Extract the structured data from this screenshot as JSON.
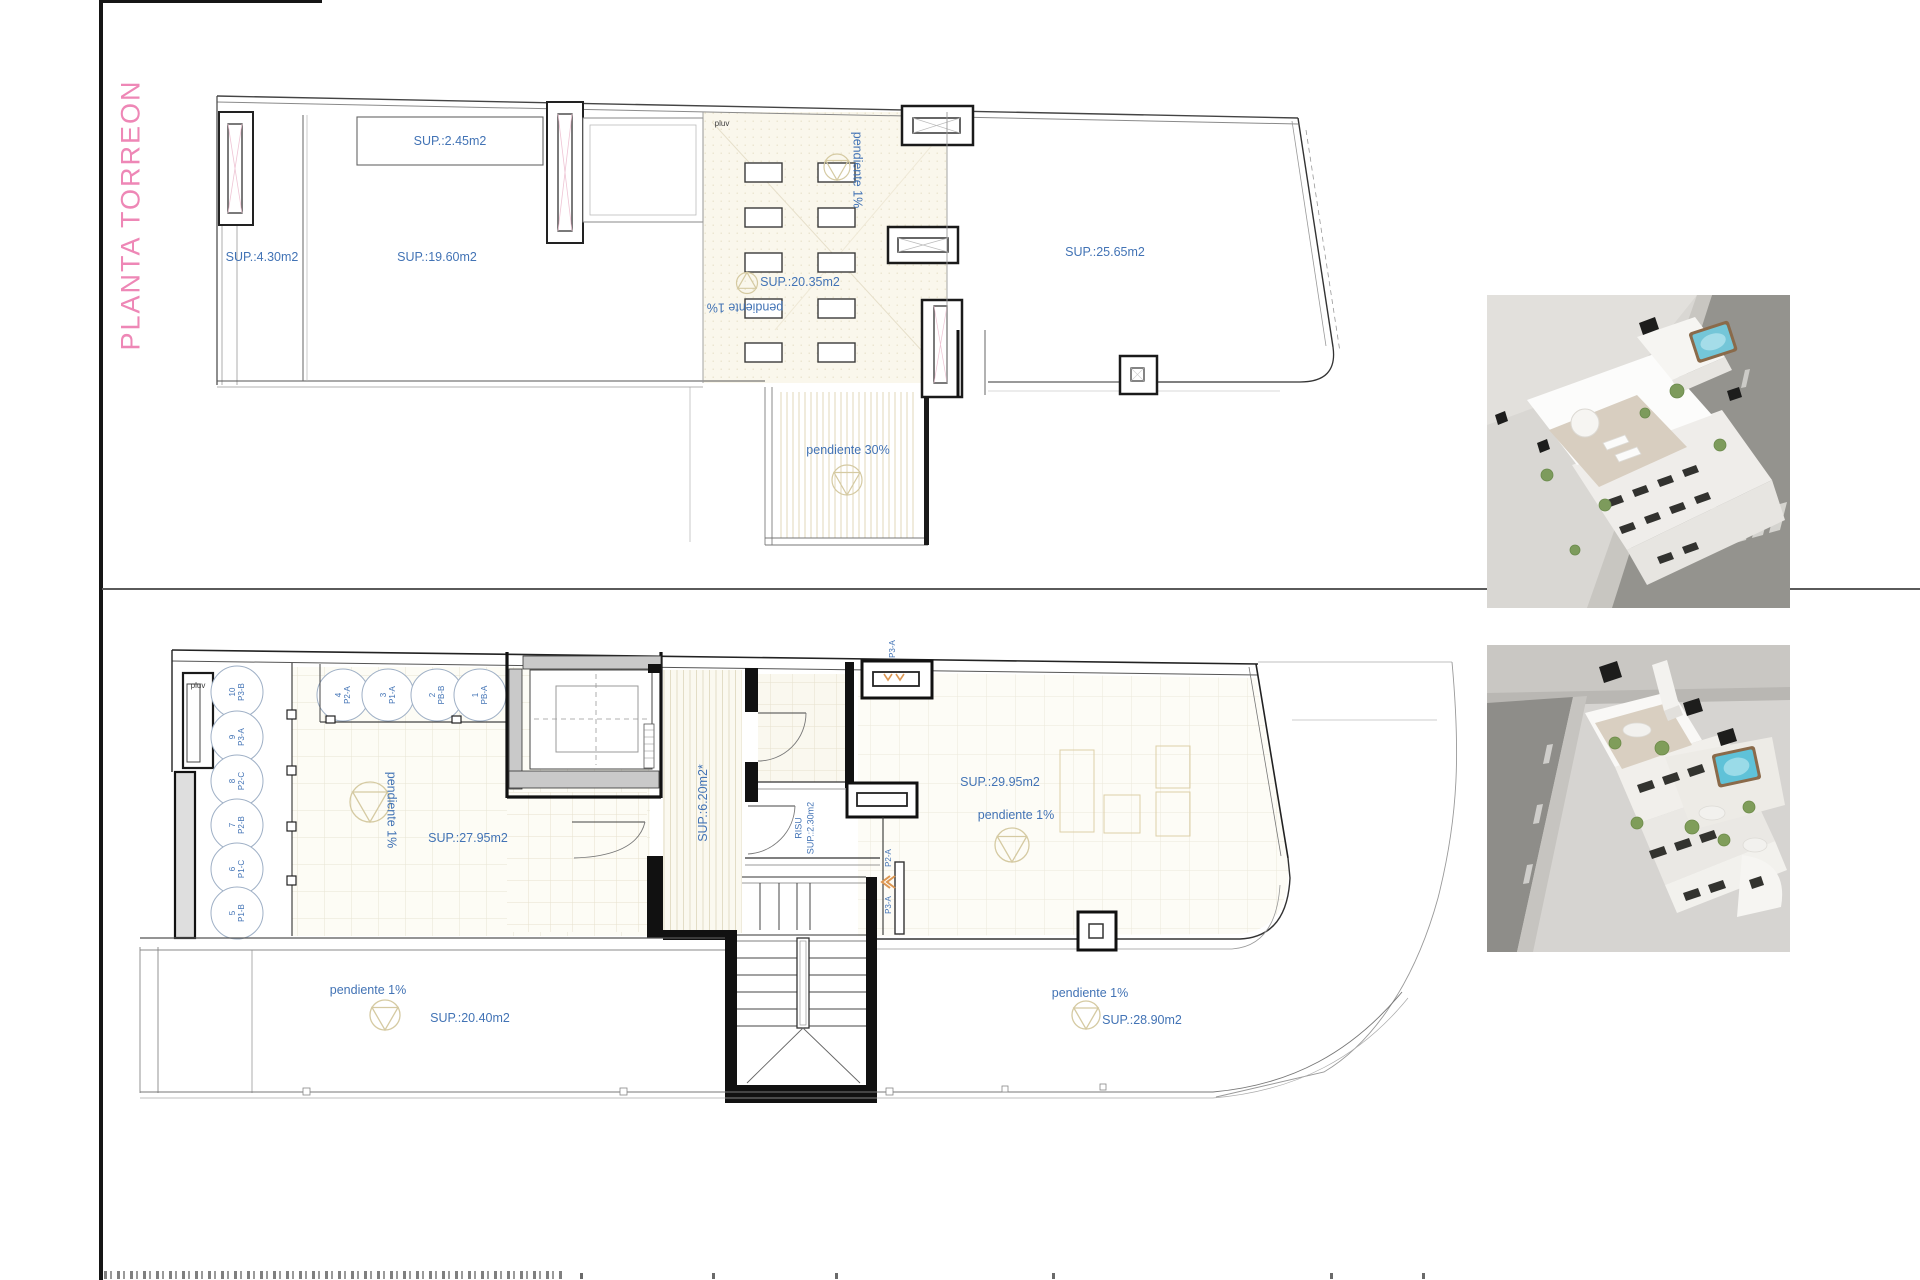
{
  "sheet": {
    "title": "PLANTA TORREON",
    "accent_pink": "#ee87b6",
    "label_blue": "#4273b5"
  },
  "top_plan": {
    "note_pluv": "pluv",
    "areas": {
      "box": "SUP.:2.45m2",
      "left_strip": "SUP.:4.30m2",
      "main": "SUP.:19.60m2",
      "mid": "SUP.:20.35m2",
      "right": "SUP.:25.65m2"
    },
    "slopes": {
      "mid_vertical": "pendiente 1%",
      "mid_inverted": "pendiente 1%",
      "ramp": "pendiente 30%"
    }
  },
  "bottom_plan": {
    "note_pluv": "pluv",
    "areas": {
      "left_terrace": "SUP.:27.95m2",
      "corridor": "SUP.:6.20m2*",
      "risu_room": "RISU",
      "risu_area": "SUP.:2.30m2",
      "right_terrace": "SUP.:29.95m2",
      "bottom_left_terrace": "SUP.:20.40m2",
      "bottom_right_terrace": "SUP.:28.90m2"
    },
    "slopes": {
      "left_terrace": "pendiente 1%",
      "right_terrace": "pendiente 1%",
      "bottom_left": "pendiente 1%",
      "bottom_right": "pendiente 1%"
    },
    "tanks_left": [
      {
        "num": "10",
        "code": "P3-B"
      },
      {
        "num": "9",
        "code": "P3-A"
      },
      {
        "num": "8",
        "code": "P2-C"
      },
      {
        "num": "7",
        "code": "P2-B"
      },
      {
        "num": "6",
        "code": "P1-C"
      },
      {
        "num": "5",
        "code": "P1-B"
      }
    ],
    "tanks_top": [
      {
        "num": "4",
        "code": "P2-A"
      },
      {
        "num": "3",
        "code": "P1-A"
      },
      {
        "num": "2",
        "code": "PB-B"
      },
      {
        "num": "1",
        "code": "PB-A"
      }
    ],
    "ducts": {
      "top_chimney": "P3-A",
      "upper": "P2-A",
      "lower": "P3-A"
    }
  }
}
